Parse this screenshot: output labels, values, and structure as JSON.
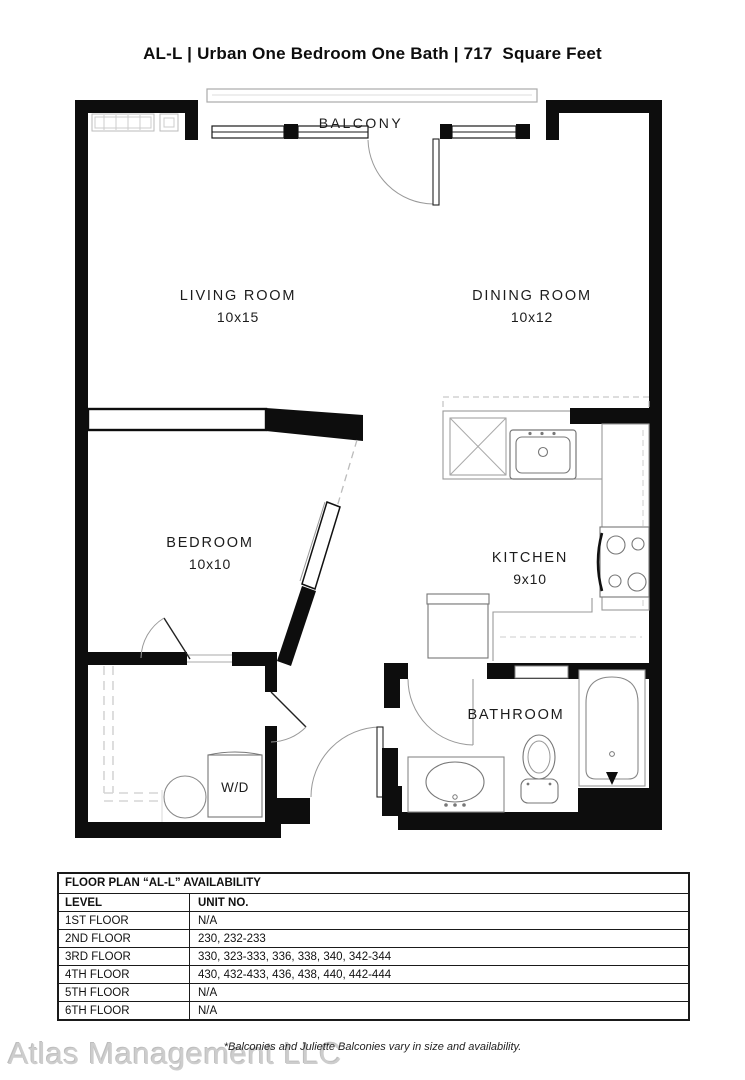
{
  "page_title": "AL-L | Urban One Bedroom One Bath | 717  Square Feet",
  "colors": {
    "wall_ink": "#0d0d0d",
    "fixture_line": "#8a8a8a"
  },
  "floor_plan": {
    "balcony_label": "BALCONY",
    "rooms": {
      "living": {
        "name": "LIVING ROOM",
        "dims": "10x15"
      },
      "dining": {
        "name": "DINING ROOM",
        "dims": "10x12"
      },
      "bedroom": {
        "name": "BEDROOM",
        "dims": "10x10"
      },
      "kitchen": {
        "name": "KITCHEN",
        "dims": "9x10"
      },
      "bathroom": {
        "name": "BATHROOM"
      },
      "laundry": {
        "name": "W/D"
      }
    }
  },
  "availability": {
    "title": "FLOOR PLAN “AL-L” AVAILABILITY",
    "columns": {
      "level": "LEVEL",
      "units": "UNIT NO."
    },
    "rows": [
      {
        "level": "1ST FLOOR",
        "units": "N/A"
      },
      {
        "level": "2ND FLOOR",
        "units": "230, 232-233"
      },
      {
        "level": "3RD FLOOR",
        "units": "330, 323-333, 336, 338, 340, 342-344"
      },
      {
        "level": "4TH FLOOR",
        "units": "430, 432-433, 436, 438, 440, 442-444"
      },
      {
        "level": "5TH FLOOR",
        "units": "N/A"
      },
      {
        "level": "6TH FLOOR",
        "units": "N/A"
      }
    ]
  },
  "footer": {
    "note": "*Balconies and Juliette Balconies vary in size and availability.",
    "watermark": "Atlas Management LLC"
  }
}
